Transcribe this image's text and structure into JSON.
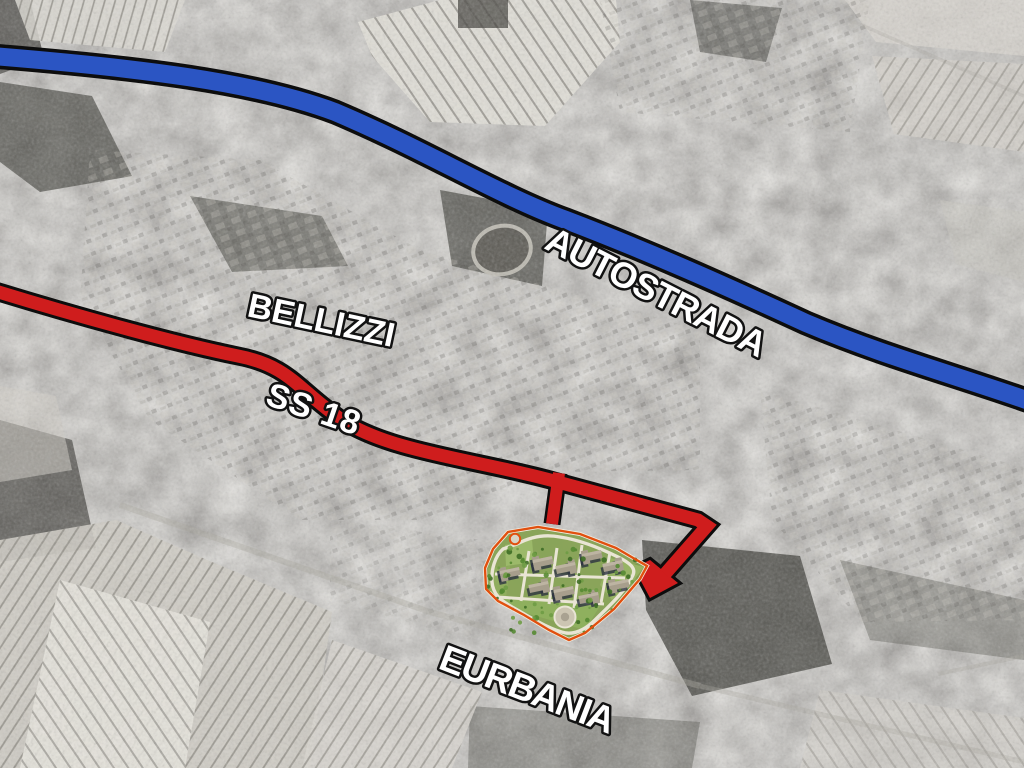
{
  "map": {
    "labels": {
      "autostrada": "AUTOSTRADA",
      "bellizzi": "BELLIZZI",
      "ss18": "SS 18",
      "eurbania": "EURBANIA"
    },
    "colors": {
      "autostrada_blue": "#2b55c3",
      "ss18_red": "#cf1d1d",
      "road_casing": "#0d0d0d",
      "site_outline": "#e1500f",
      "site_green": "#87a355",
      "label_fill": "#ffffff",
      "label_outline": "#121212"
    }
  }
}
